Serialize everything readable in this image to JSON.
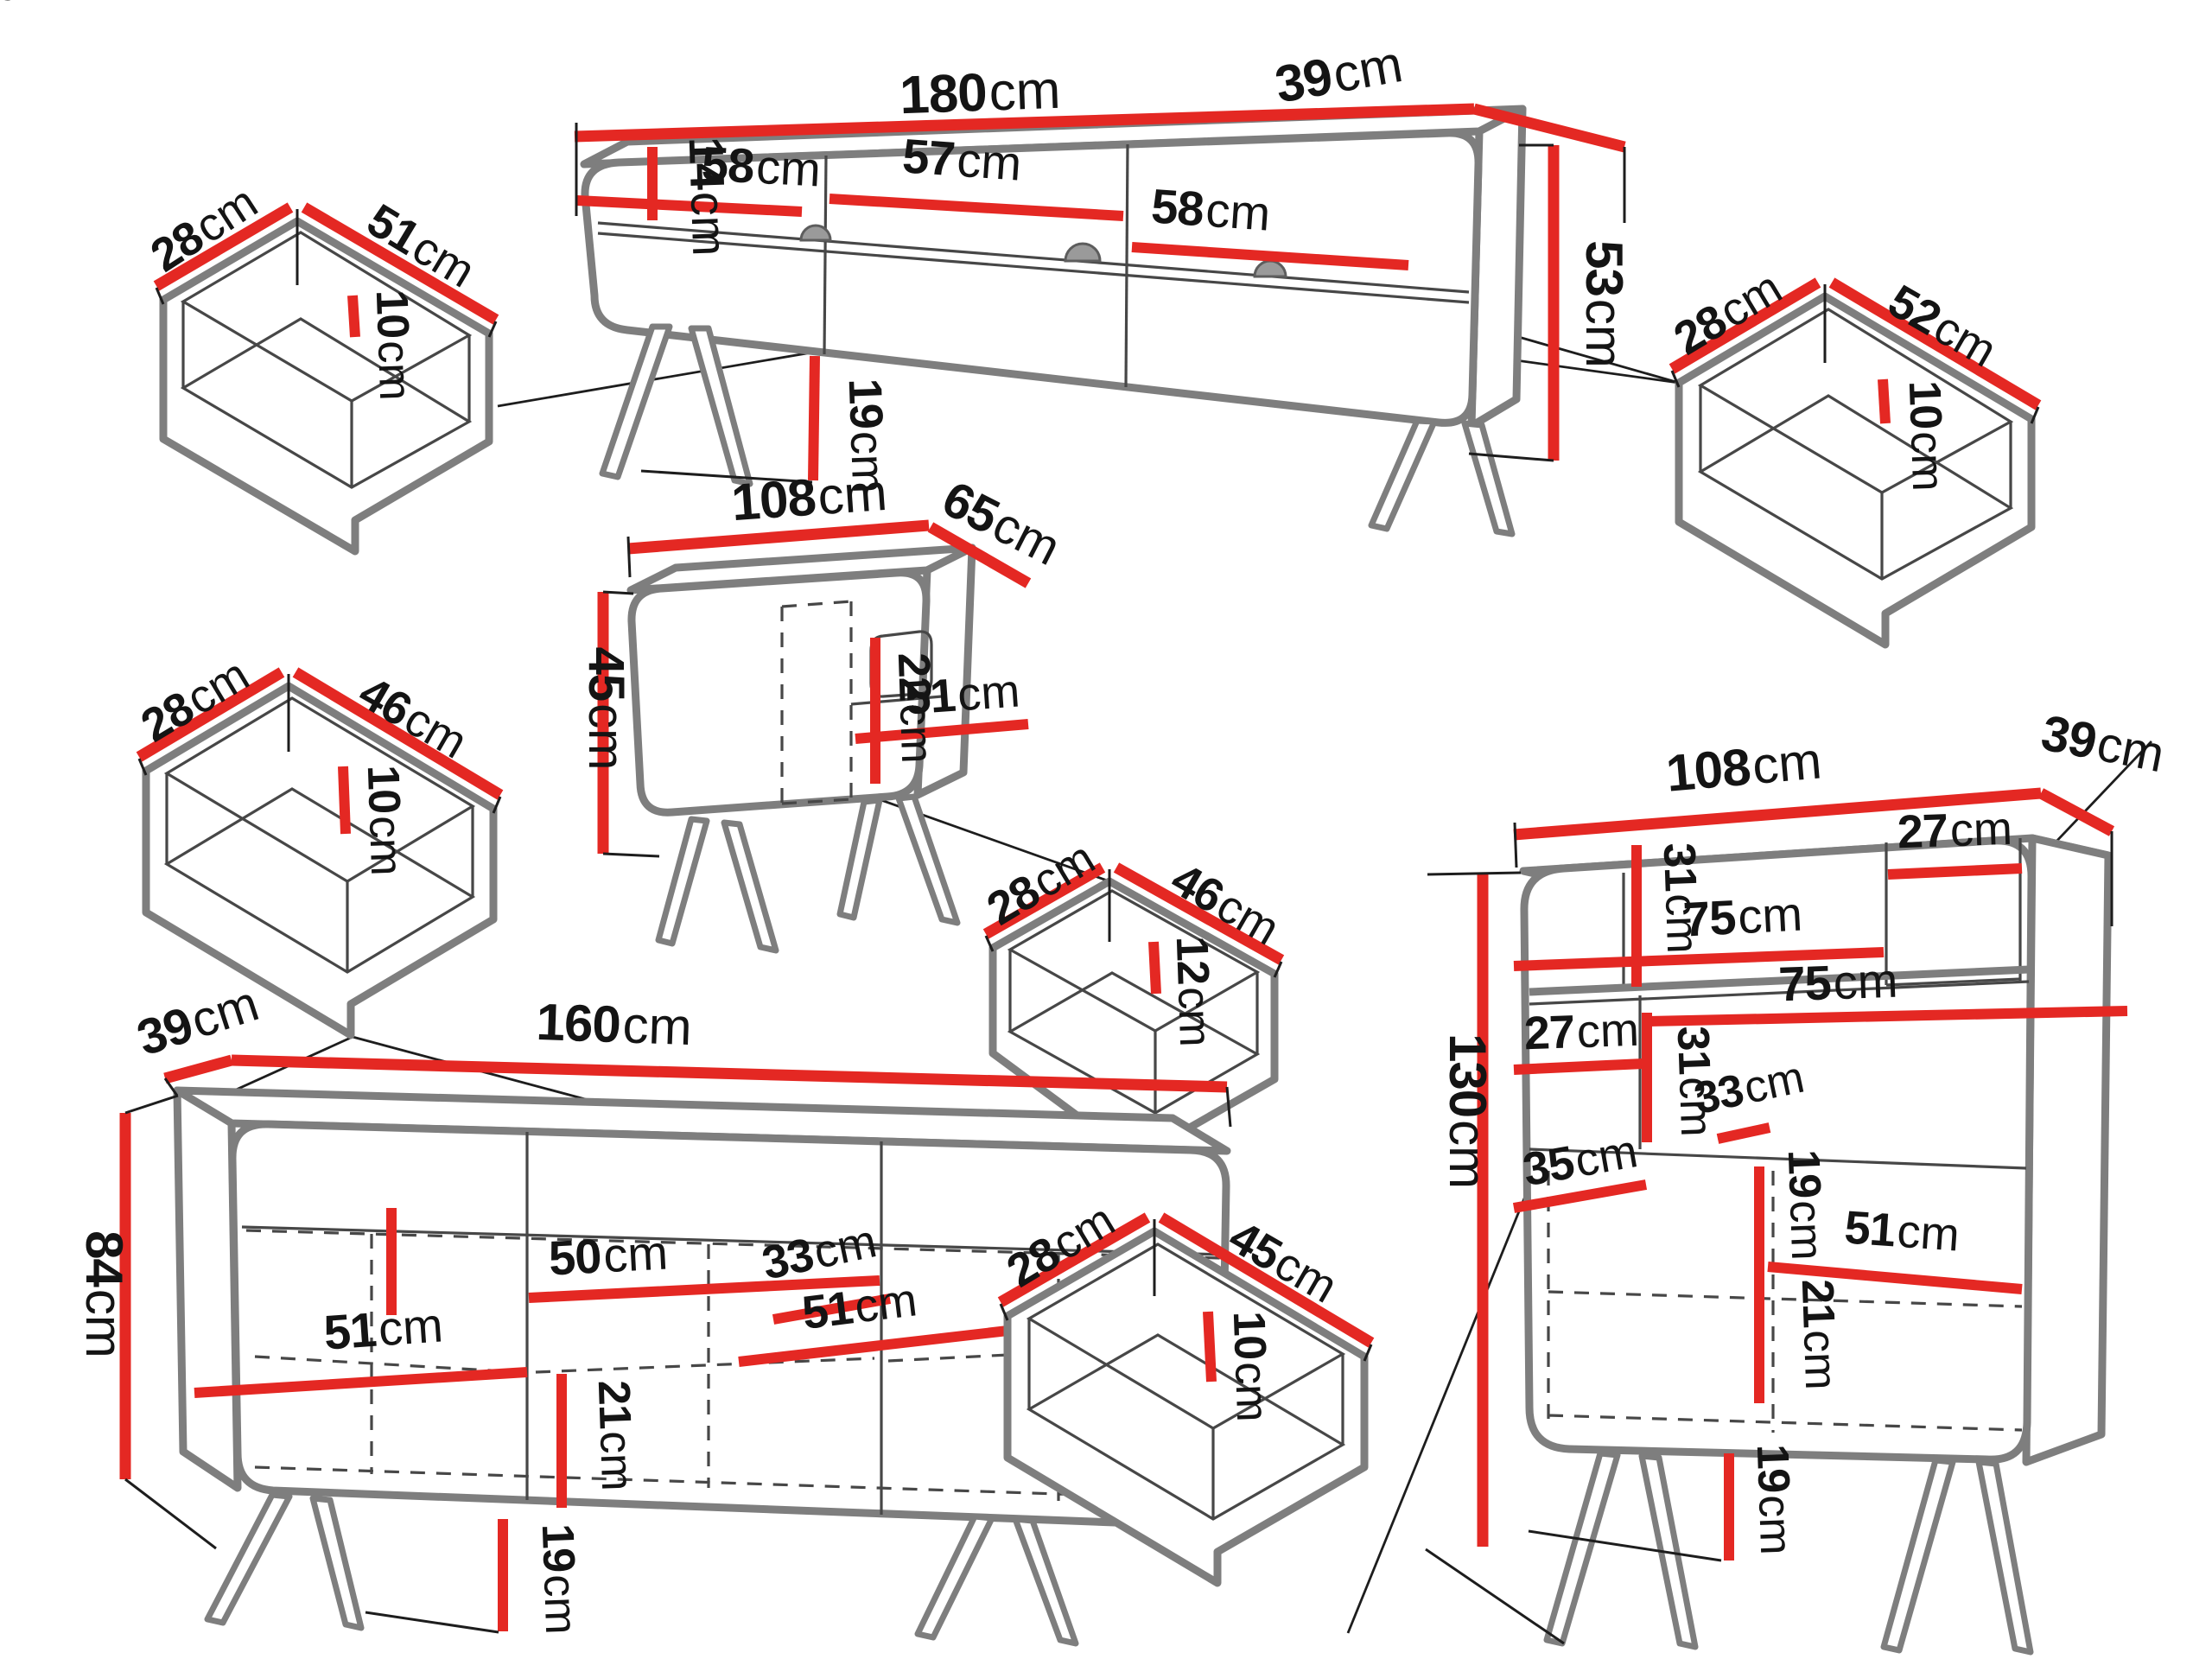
{
  "title": "Furniture set dimension diagram",
  "palette": {
    "red": "#e42823",
    "gray": "#7e7e7e",
    "ink": "#141414",
    "bg": "#ffffff"
  },
  "pieces": [
    {
      "name": "tv-stand",
      "width": "180cm",
      "depth": "39cm",
      "height": "53cm",
      "niche_widths": [
        "58cm",
        "57cm",
        "58cm"
      ],
      "niche_height": "14cm",
      "leg_height": "19cm"
    },
    {
      "name": "drawer-top-left",
      "width": "51cm",
      "depth": "28cm",
      "height": "10cm"
    },
    {
      "name": "drawer-top-right",
      "width": "52cm",
      "depth": "28cm",
      "height": "10cm"
    },
    {
      "name": "coffee-table",
      "width": "108cm",
      "depth": "65cm",
      "height": "45cm",
      "niche_height": "22cm",
      "niche_width": "51cm"
    },
    {
      "name": "drawer-middle-left",
      "width": "46cm",
      "depth": "28cm",
      "height": "10cm"
    },
    {
      "name": "drawer-coffee-table",
      "width": "46cm",
      "depth": "28cm",
      "height": "12cm"
    },
    {
      "name": "sideboard",
      "width": "160cm",
      "depth": "39cm",
      "height": "84cm",
      "inner_dims": [
        "22cm",
        "50cm",
        "33cm",
        "51cm",
        "51cm",
        "21cm"
      ],
      "leg_height": "19cm"
    },
    {
      "name": "drawer-sideboard",
      "width": "45cm",
      "depth": "28cm",
      "height": "10cm"
    },
    {
      "name": "bookcase",
      "width": "108cm",
      "depth": "39cm",
      "height": "130cm",
      "inner_dims": [
        "31cm",
        "27cm",
        "75cm",
        "75cm",
        "27cm",
        "31cm",
        "33cm",
        "35cm",
        "19cm",
        "51cm",
        "21cm"
      ],
      "leg_height": "19cm"
    }
  ],
  "dims": [
    {
      "num": "180",
      "unit": "cm"
    },
    {
      "num": "39",
      "unit": "cm"
    },
    {
      "num": "53",
      "unit": "cm"
    },
    {
      "num": "14",
      "unit": "cm"
    },
    {
      "num": "58",
      "unit": "cm"
    },
    {
      "num": "57",
      "unit": "cm"
    },
    {
      "num": "58",
      "unit": "cm"
    },
    {
      "num": "19",
      "unit": "cm"
    },
    {
      "num": "28",
      "unit": "cm"
    },
    {
      "num": "51",
      "unit": "cm"
    },
    {
      "num": "10",
      "unit": "cm"
    },
    {
      "num": "28",
      "unit": "cm"
    },
    {
      "num": "52",
      "unit": "cm"
    },
    {
      "num": "10",
      "unit": "cm"
    },
    {
      "num": "108",
      "unit": "cm"
    },
    {
      "num": "65",
      "unit": "cm"
    },
    {
      "num": "45",
      "unit": "cm"
    },
    {
      "num": "22",
      "unit": "cm"
    },
    {
      "num": "51",
      "unit": "cm"
    },
    {
      "num": "28",
      "unit": "cm"
    },
    {
      "num": "46",
      "unit": "cm"
    },
    {
      "num": "10",
      "unit": "cm"
    },
    {
      "num": "28",
      "unit": "cm"
    },
    {
      "num": "46",
      "unit": "cm"
    },
    {
      "num": "12",
      "unit": "cm"
    },
    {
      "num": "39",
      "unit": "cm"
    },
    {
      "num": "160",
      "unit": "cm"
    },
    {
      "num": "84",
      "unit": "cm"
    },
    {
      "num": "22",
      "unit": "cm"
    },
    {
      "num": "50",
      "unit": "cm"
    },
    {
      "num": "33",
      "unit": "cm"
    },
    {
      "num": "51",
      "unit": "cm"
    },
    {
      "num": "51",
      "unit": "cm"
    },
    {
      "num": "21",
      "unit": "cm"
    },
    {
      "num": "19",
      "unit": "cm"
    },
    {
      "num": "28",
      "unit": "cm"
    },
    {
      "num": "45",
      "unit": "cm"
    },
    {
      "num": "10",
      "unit": "cm"
    },
    {
      "num": "108",
      "unit": "cm"
    },
    {
      "num": "39",
      "unit": "cm"
    },
    {
      "num": "130",
      "unit": "cm"
    },
    {
      "num": "31",
      "unit": "cm"
    },
    {
      "num": "27",
      "unit": "cm"
    },
    {
      "num": "75",
      "unit": "cm"
    },
    {
      "num": "75",
      "unit": "cm"
    },
    {
      "num": "27",
      "unit": "cm"
    },
    {
      "num": "31",
      "unit": "cm"
    },
    {
      "num": "33",
      "unit": "cm"
    },
    {
      "num": "35",
      "unit": "cm"
    },
    {
      "num": "19",
      "unit": "cm"
    },
    {
      "num": "51",
      "unit": "cm"
    },
    {
      "num": "21",
      "unit": "cm"
    },
    {
      "num": "19",
      "unit": "cm"
    }
  ]
}
